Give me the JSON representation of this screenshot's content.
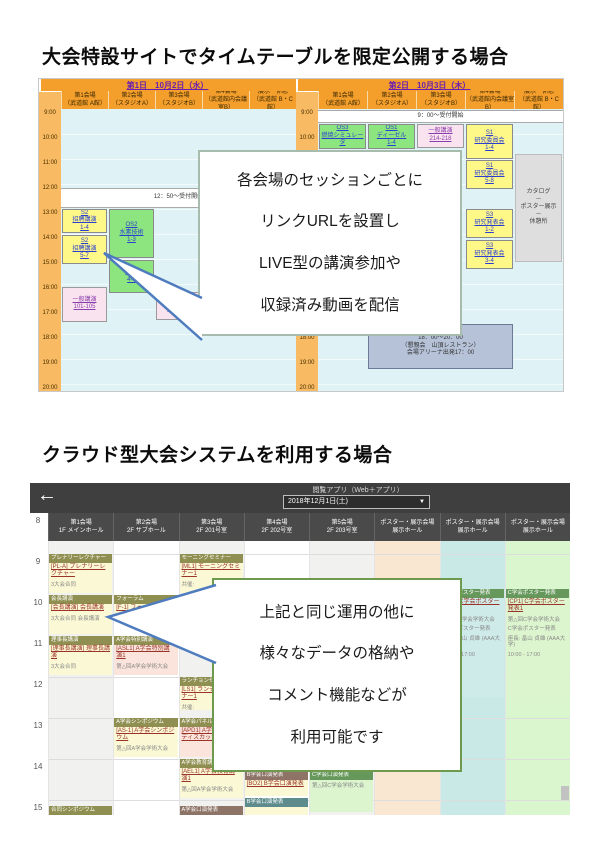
{
  "colors": {
    "header_orange": "#F49E2C",
    "gutter_orange": "#F8BA62",
    "body_cyan": "#DFF2F5",
    "session_yellow": "#FEF889",
    "session_green": "#8CE57E",
    "session_pink": "#F9E3EE",
    "banquet_navy": "#B6C2D8",
    "appbar_dark": "#3f3f3f",
    "bar_olive": "#8F8F51",
    "bar_brown": "#8D7466",
    "bar_teal": "#5E8C8C",
    "bar_dgreen": "#66985C",
    "link_red": "#9c3328",
    "tail_blue": "#4E7CBE"
  },
  "section1": {
    "heading": "大会特設サイトでタイムテーブルを限定公開する場合",
    "bubble": {
      "lines": [
        "各会場のセッションごとに",
        "リンクURLを設置し",
        "LIVE型の講演参加や",
        "収録済み動画を配信"
      ]
    },
    "table": {
      "time_labels": [
        "9:00",
        "10:00",
        "11:00",
        "12:00",
        "13:00",
        "14:00",
        "15:00",
        "16:00",
        "17:00",
        "18:00",
        "19:00",
        "20:00"
      ],
      "days": [
        {
          "label": "第1日　10月2日（水）",
          "venues": [
            {
              "line1": "第1会場",
              "line2": "（武道館 A館）"
            },
            {
              "line1": "第2会場",
              "line2": "（スタジオA）"
            },
            {
              "line1": "第3会場",
              "line2": "（スタジオB）"
            },
            {
              "line1": "第4会場",
              "line2": "（武道館内会議室B）"
            },
            {
              "line1": "展示・休憩",
              "line2": "（武道館 B・C館）"
            }
          ]
        },
        {
          "label": "第2日　10月3日（木）",
          "venues": [
            {
              "line1": "第1会場",
              "line2": "（武道館 A館）"
            },
            {
              "line1": "第2会場",
              "line2": "（スタジオA）"
            },
            {
              "line1": "第3会場",
              "line2": "（スタジオB）"
            },
            {
              "line1": "第4会場",
              "line2": "（武道館内会議室B）"
            },
            {
              "line1": "展示・休憩",
              "line2": "（武道館 B・C館）"
            }
          ]
        }
      ],
      "sessions": [
        {
          "day": 0,
          "col": 0,
          "span": 5,
          "start": 12.15,
          "end": 12.95,
          "type": "band",
          "link": false,
          "lines": [
            "12：50～受付開始"
          ]
        },
        {
          "day": 0,
          "col": 0,
          "span": 1,
          "start": 13.0,
          "end": 13.95,
          "type": "yellow",
          "link": true,
          "lines": [
            "S2",
            "招聘講演",
            "1-4"
          ]
        },
        {
          "day": 0,
          "col": 0,
          "span": 1,
          "start": 14.05,
          "end": 15.2,
          "type": "yellow",
          "link": true,
          "lines": [
            "S2",
            "招聘講演",
            "5-7"
          ]
        },
        {
          "day": 0,
          "col": 1,
          "span": 1,
          "start": 13.0,
          "end": 14.95,
          "type": "green",
          "link": true,
          "lines": [
            "OS2",
            "水素技術",
            "1-3"
          ]
        },
        {
          "day": 0,
          "col": 1,
          "span": 1,
          "start": 15.05,
          "end": 16.35,
          "type": "green",
          "link": true,
          "lines": [
            "OS2",
            "4-5"
          ]
        },
        {
          "day": 0,
          "col": 3,
          "span": 1,
          "start": 13.0,
          "end": 14.55,
          "type": "pink",
          "link": true,
          "lines": [
            "一般講演",
            "201-206"
          ]
        },
        {
          "day": 0,
          "col": 0,
          "span": 1,
          "start": 16.1,
          "end": 17.5,
          "type": "pink",
          "link": true,
          "lines": [
            "一般講演",
            "101-105"
          ]
        },
        {
          "day": 0,
          "col": 2,
          "span": 1,
          "start": 16.3,
          "end": 17.45,
          "type": "pink",
          "link": true,
          "lines": [
            "一般講演",
            "310-312"
          ]
        },
        {
          "day": 1,
          "col": 0,
          "span": 5,
          "start": 9.05,
          "end": 9.55,
          "type": "band",
          "link": false,
          "lines": [
            "9：00～受付開始"
          ]
        },
        {
          "day": 1,
          "col": 0,
          "span": 1,
          "start": 9.6,
          "end": 10.6,
          "type": "green",
          "link": true,
          "lines": [
            "OS3",
            "燃焼シミュレータ"
          ]
        },
        {
          "day": 1,
          "col": 1,
          "span": 1,
          "start": 9.6,
          "end": 10.6,
          "type": "green",
          "link": true,
          "lines": [
            "OS1",
            "ディーゼル",
            "1-4"
          ]
        },
        {
          "day": 1,
          "col": 2,
          "span": 1,
          "start": 9.6,
          "end": 10.55,
          "type": "pink",
          "link": true,
          "lines": [
            "一般講演",
            "214-218"
          ]
        },
        {
          "day": 1,
          "col": 3,
          "span": 1,
          "start": 9.6,
          "end": 11.0,
          "type": "yellow",
          "link": true,
          "lines": [
            "S1",
            "研究委員会",
            "1-4"
          ]
        },
        {
          "day": 1,
          "col": 3,
          "span": 1,
          "start": 11.05,
          "end": 12.2,
          "type": "yellow",
          "link": true,
          "lines": [
            "S1",
            "研究委員会",
            "5-8"
          ]
        },
        {
          "day": 1,
          "col": 3,
          "span": 1,
          "start": 13.0,
          "end": 14.15,
          "type": "yellow",
          "link": true,
          "lines": [
            "S3",
            "研究発表会",
            "1-2"
          ]
        },
        {
          "day": 1,
          "col": 3,
          "span": 1,
          "start": 14.25,
          "end": 15.4,
          "type": "yellow",
          "link": true,
          "lines": [
            "S3",
            "研究発表会",
            "3-4"
          ]
        },
        {
          "day": 1,
          "col": 4,
          "span": 1,
          "start": 10.8,
          "end": 15.1,
          "type": "gray",
          "link": false,
          "lines": [
            "カタログ",
            "－",
            "ポスター展示",
            "－",
            "休憩所"
          ]
        },
        {
          "day": 1,
          "col": 1,
          "span": 3,
          "start": 17.6,
          "end": 19.4,
          "type": "navy",
          "link": false,
          "lines": [
            "18：00～20：00",
            "（懇親会　山頂レストラン）",
            "会場アリーナ出発17：00"
          ]
        }
      ]
    }
  },
  "section2": {
    "heading": "クラウド型大会システムを利用する場合",
    "bubble": {
      "lines": [
        "上記と同じ運用の他に",
        "様々なデータの格納や",
        "コメント機能などが",
        "利用可能です"
      ]
    },
    "app_bar": {
      "back": "←",
      "label": "閲覧アプリ（Web＋アプリ）",
      "date_value": "2018年12月1日(土)",
      "caret": "▼"
    },
    "row_numbers": [
      "8",
      "9",
      "10",
      "11",
      "12",
      "13",
      "14",
      "15"
    ],
    "columns": [
      {
        "line1": "第1会場",
        "line2": "1F メインホール"
      },
      {
        "line1": "第2会場",
        "line2": "2F サブホール"
      },
      {
        "line1": "第3会場",
        "line2": "2F 201号室"
      },
      {
        "line1": "第4会場",
        "line2": "2F 202号室"
      },
      {
        "line1": "第5会場",
        "line2": "2F 203号室"
      },
      {
        "line1": "ポスター・展示会場",
        "line2": "展示ホール"
      },
      {
        "line1": "ポスター・展示会場",
        "line2": "展示ホール"
      },
      {
        "line1": "ポスター・展示会場",
        "line2": "展示ホール"
      }
    ],
    "sessions": [
      {
        "col": 0,
        "start": 9.0,
        "end": 9.95,
        "bar": "プレナリーレクチャー",
        "barc": "olive",
        "body": "yellow",
        "link": "[PL-A] プレナリーレクチャー",
        "subs": [
          "3大会合同"
        ]
      },
      {
        "col": 2,
        "start": 9.0,
        "end": 9.95,
        "bar": "モーニングセミナー",
        "barc": "olive",
        "body": "yellow",
        "link": "[ML1] モーニングセミナー1",
        "subs": [
          "共催:"
        ]
      },
      {
        "col": 0,
        "start": 10.0,
        "end": 10.95,
        "bar": "会長講演",
        "barc": "olive",
        "body": "yellow",
        "link": "[会長講演] 会長講演",
        "subs": [
          "3大会合同 会長講演"
        ]
      },
      {
        "col": 1,
        "start": 10.0,
        "end": 10.55,
        "bar": "フォーラム",
        "barc": "olive",
        "body": "yellow",
        "link": "[F-1] フォーラム",
        "subs": []
      },
      {
        "col": 0,
        "start": 11.0,
        "end": 11.95,
        "bar": "理事長講演",
        "barc": "olive",
        "body": "yellow",
        "link": "[理事長講演] 理事長講演",
        "subs": [
          "3大会合同"
        ]
      },
      {
        "col": 1,
        "start": 11.0,
        "end": 11.95,
        "bar": "A学会特別講演",
        "barc": "olive",
        "body": "pink",
        "link": "[ASL1] A学会特別講演1",
        "subs": [
          "第△回A学会学術大会"
        ]
      },
      {
        "col": 2,
        "start": 12.0,
        "end": 12.8,
        "bar": "ランチョンセミナー",
        "barc": "olive",
        "body": "yellow",
        "link": "[LS1] ランチョンセミナー1",
        "subs": [
          "共催:"
        ]
      },
      {
        "col": 1,
        "start": 13.0,
        "end": 13.95,
        "bar": "A学会シンポジウム",
        "barc": "olive",
        "body": "yellow",
        "link": "[AS-1] A学会シンポジウム",
        "subs": [
          "第△回A学会学術大会"
        ]
      },
      {
        "col": 2,
        "start": 13.0,
        "end": 13.95,
        "bar": "A学会パネルディスカッション",
        "barc": "olive",
        "body": "pink",
        "link": "[APD1] A学会パネルディスカッション1",
        "subs": []
      },
      {
        "col": 2,
        "start": 14.0,
        "end": 14.95,
        "bar": "A学会教育講演",
        "barc": "olive",
        "body": "yellow",
        "link": "[AEL1] A学会教育講演1",
        "subs": [
          "第△回A学会学術大会"
        ]
      },
      {
        "col": 3,
        "start": 14.3,
        "end": 14.9,
        "bar": "B学会口演発表",
        "barc": "brown",
        "body": "yellow",
        "link": "[BO2] B学会口演発表",
        "subs": []
      },
      {
        "col": 4,
        "start": 14.3,
        "end": 15.3,
        "bar": "C学会口演発表",
        "barc": "dgreen",
        "body": "green",
        "link": "",
        "subs": [
          "第△回C学会学術大会"
        ]
      },
      {
        "col": 6,
        "start": 9.85,
        "end": 12.5,
        "bar": "C学会ポスター発表",
        "barc": "dgreen",
        "body": "teal",
        "link": "[CP1] C学会ポスター発表1",
        "subs": [
          "第△回C学会学術大会",
          "C学会ポスター発表",
          "座長: 畠山 貞雄 (AAA大学)",
          "10:00 - 17:00"
        ]
      },
      {
        "col": 7,
        "start": 9.85,
        "end": 12.5,
        "bar": "C学会ポスター発表",
        "barc": "dgreen",
        "body": "green",
        "link": "[CP1] C学会ポスター発表1",
        "subs": [
          "第△回C学会学術大会",
          "C学会ポスター発表",
          "座長: 畠山 貞雄 (AAA大学)",
          "10:00 - 17:00"
        ]
      },
      {
        "col": 0,
        "start": 15.15,
        "end": 15.6,
        "bar": "合同シンポジウム",
        "barc": "olive",
        "body": "yellow",
        "link": "",
        "subs": []
      },
      {
        "col": 2,
        "start": 15.15,
        "end": 15.6,
        "bar": "A学会口演発表",
        "barc": "brown",
        "body": "yellow",
        "link": "",
        "subs": []
      },
      {
        "col": 3,
        "start": 14.95,
        "end": 15.6,
        "bar": "B学会口演発表",
        "barc": "teal",
        "body": "yellow",
        "link": "",
        "subs": []
      }
    ]
  }
}
